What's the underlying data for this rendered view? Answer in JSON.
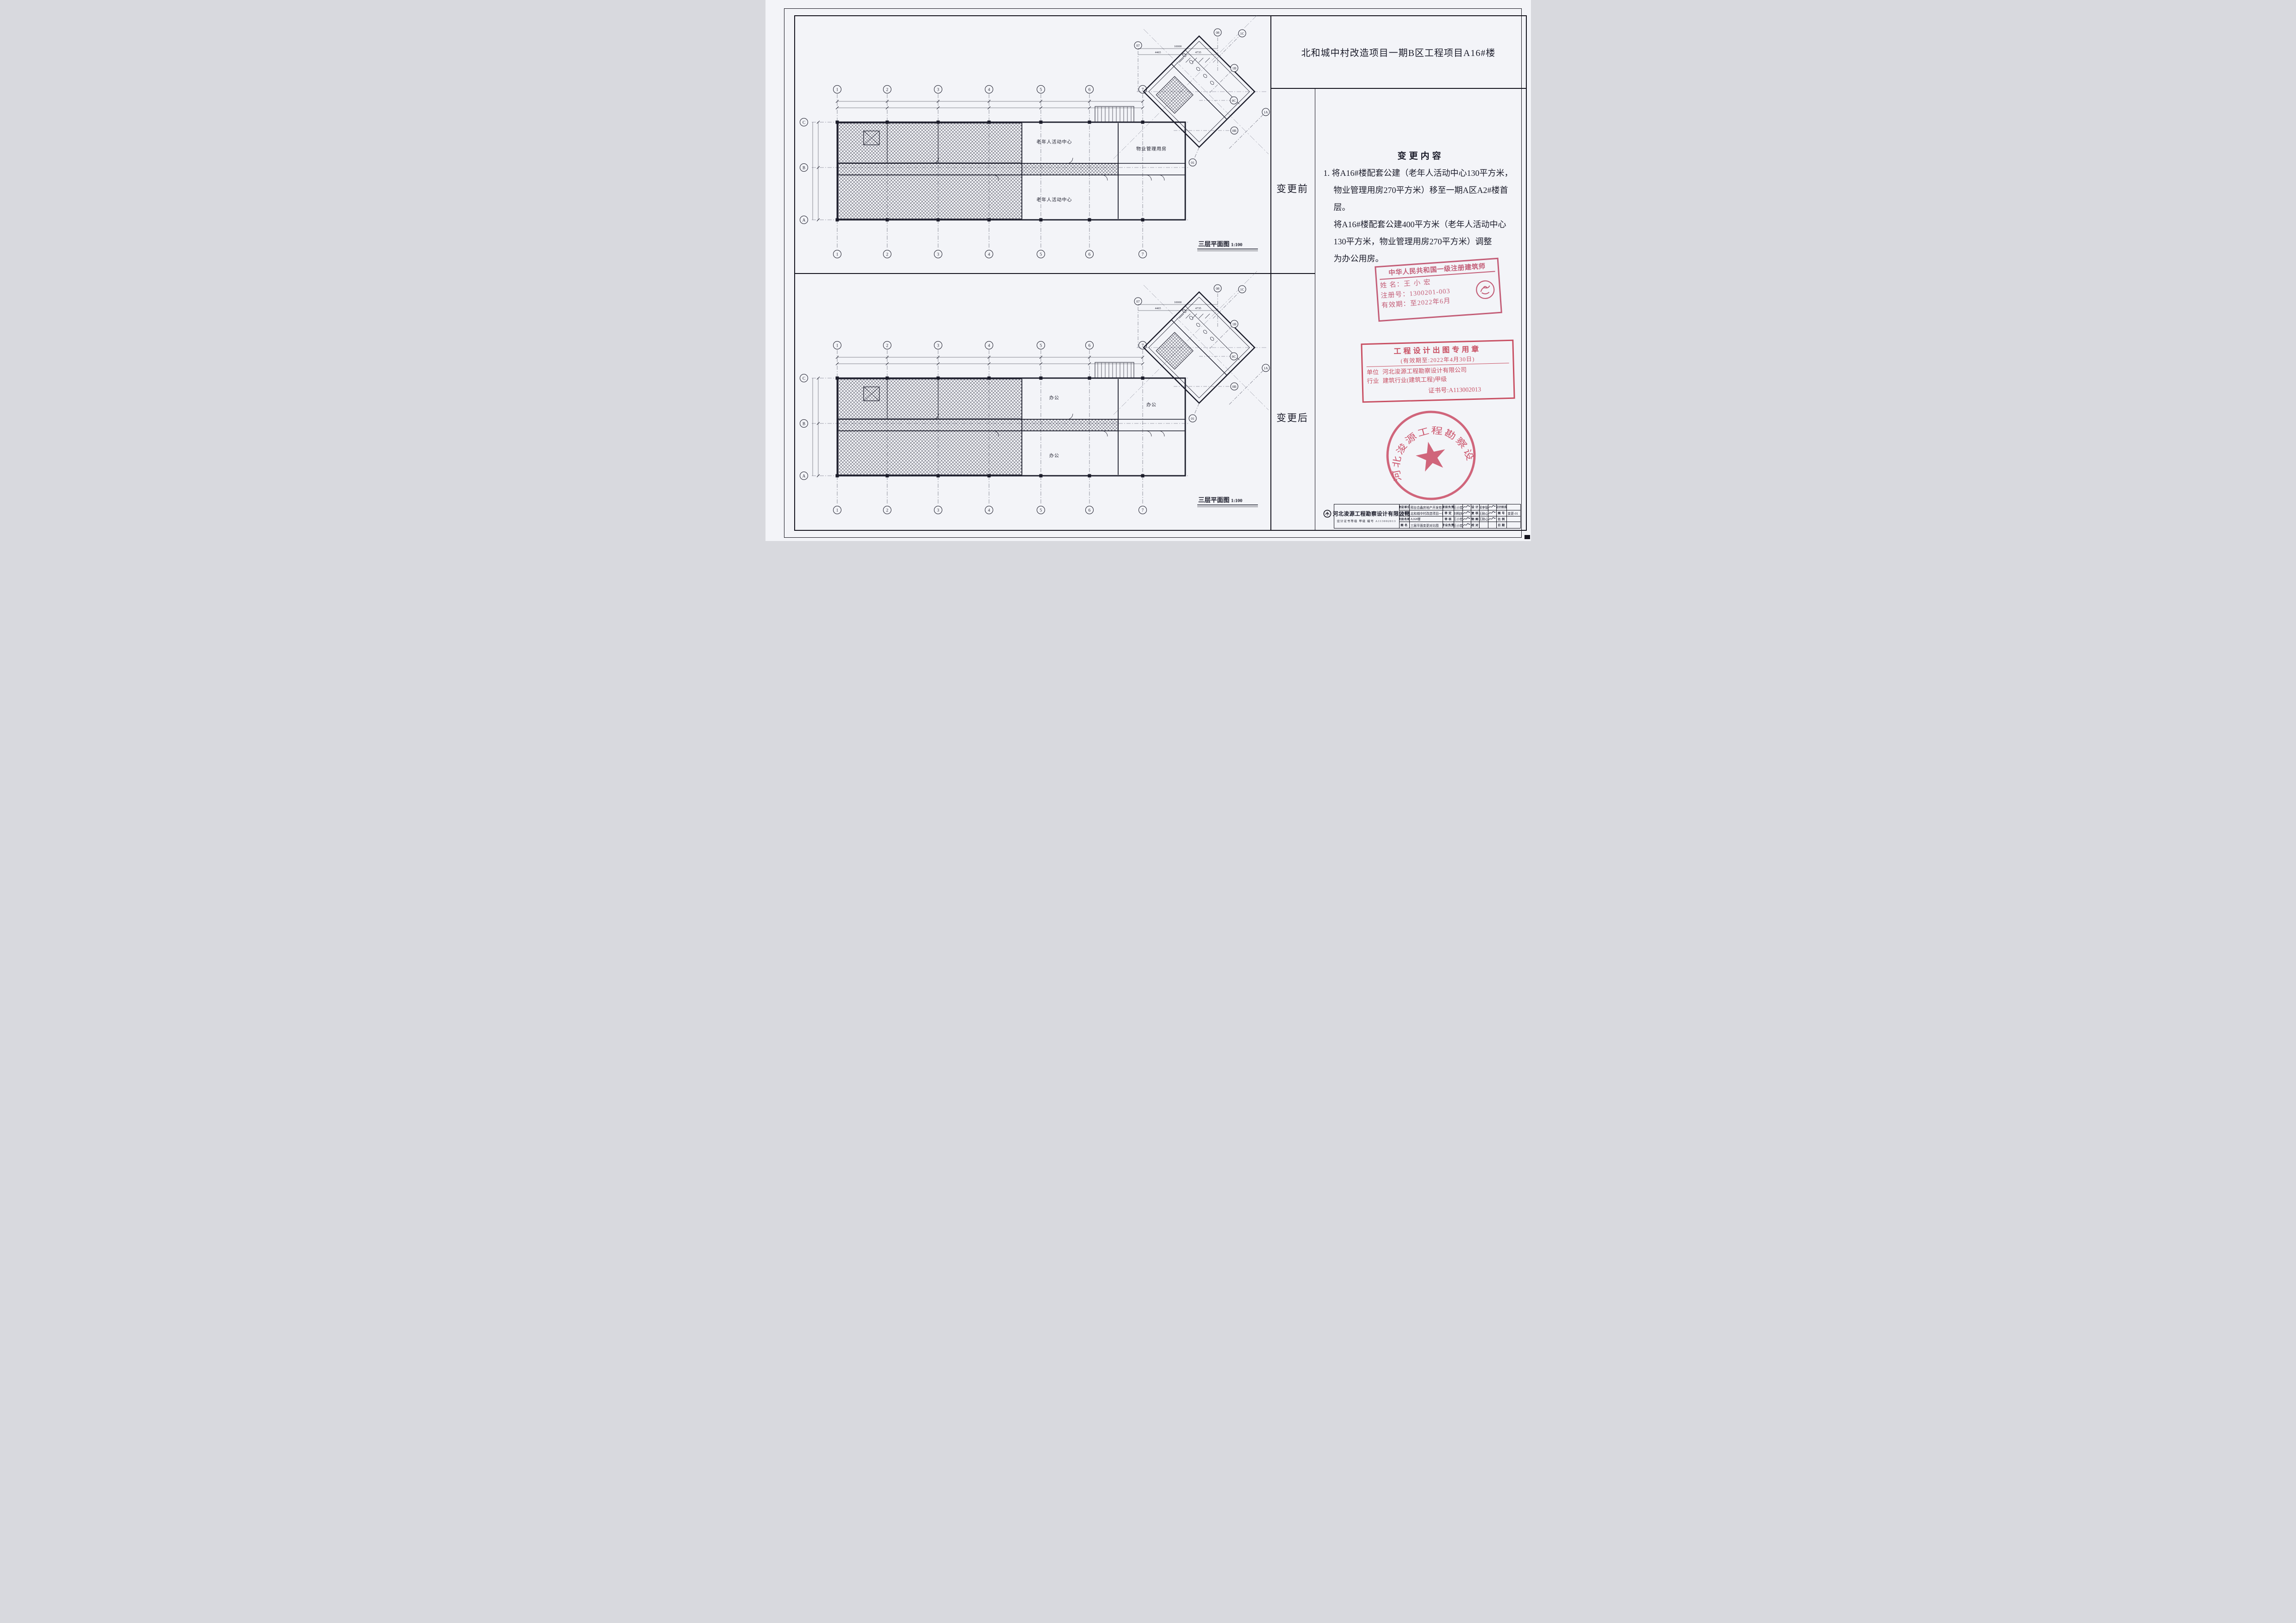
{
  "header": {
    "title": "北和城中村改造项目一期B区工程项目A16#楼"
  },
  "panel": {
    "before_label": "变更前",
    "after_label": "变更后"
  },
  "change": {
    "heading": "变更内容",
    "lines": [
      "1. 将A16#楼配套公建（老年人活动中心130平方米，",
      "物业管理用房270平方米）移至一期A区A2#楼首",
      "层。",
      "将A16#楼配套公建400平方米（老年人活动中心",
      "130平方米，物业管理用房270平方米）调整",
      "为办公用房。"
    ]
  },
  "stamps": {
    "architect": {
      "title": "中华人民共和国一级注册建筑师",
      "name_label": "姓  名：",
      "name": "王小宏",
      "reg_label": "注册号：",
      "reg": "1300201-003",
      "valid_label": "有效期：",
      "valid": "至2022年6月"
    },
    "design_chop": {
      "title": "工程设计出图专用章",
      "validity": "(有效期至:2022年4月30日)",
      "unit_label": "单位",
      "unit": "河北浚源工程勘察设计有限公司",
      "industry_label": "行业",
      "industry": "建筑行业(建筑工程)甲级",
      "cert": "证书号:A113002013"
    },
    "company_seal": {
      "text": "河北浚源工程勘察设计有限公司"
    }
  },
  "titleblock": {
    "company": "河北浚源工程勘察设计有限公司",
    "cert_line": "设计证书等级 甲级 编号 A113002013",
    "rows": [
      [
        "建设单位",
        "邢台合鑫房地产开发有限公司",
        "项目负责",
        "王小宏",
        "sig",
        "设 计",
        "邢李智",
        "sig",
        "设计阶段",
        ""
      ],
      [
        "工程名称",
        "北和城中村改造项目一期B区工程项目",
        "审 定",
        "刘明庆",
        "sig",
        "复 核",
        "王耐心",
        "sig",
        "图 号",
        "变更-01"
      ],
      [
        "项目名称",
        "A16#楼",
        "审 核",
        "王小宏",
        "sig",
        "制 图",
        "王耐心",
        "sig",
        "比 例",
        ""
      ],
      [
        "图  名",
        "三层平面变更对比图",
        "专业负责",
        "王小宏",
        "sig",
        "校 对",
        "",
        "",
        "日 期",
        ""
      ]
    ]
  },
  "plans": [
    {
      "id": "before",
      "caption": "三层平面图",
      "scale": "1:100",
      "rooms": [
        "老年人活动中心",
        "老年人活动中心",
        "物业管理用房"
      ]
    },
    {
      "id": "after",
      "caption": "三层平面图",
      "scale": "1:100",
      "rooms": [
        "办公",
        "办公",
        "办公"
      ]
    }
  ],
  "grid": {
    "cols": [
      "1",
      "2",
      "3",
      "4",
      "5",
      "6",
      "7"
    ],
    "rows": [
      "C",
      "B",
      "A"
    ],
    "wing_bubbles": [
      "07",
      "08",
      "1C",
      "1B",
      "1A",
      "0C",
      "0B",
      "01"
    ],
    "dims": [
      "10000",
      "4465",
      "4735"
    ]
  },
  "colors": {
    "ink": "#1b1c2a",
    "stamp_red": "#c8506b",
    "seal_red": "#cf3b55",
    "paper": "#f3f4f8"
  }
}
